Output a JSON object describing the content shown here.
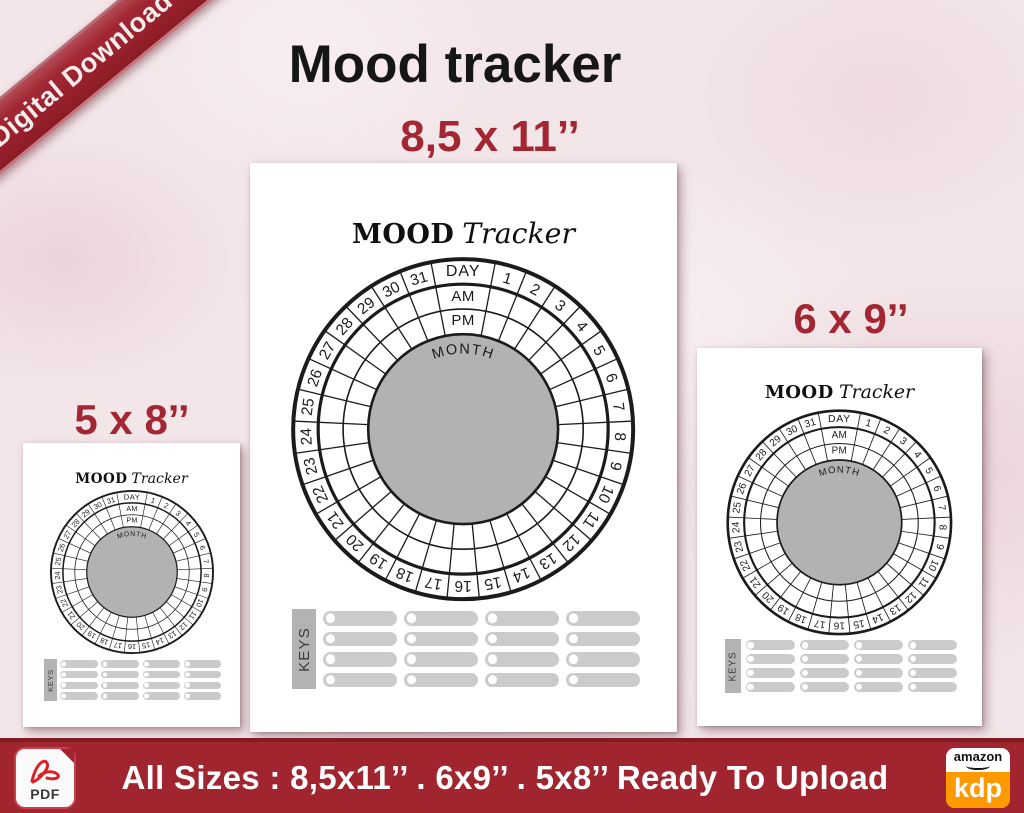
{
  "ribbon": {
    "label": "Digital Download"
  },
  "title": "Mood tracker",
  "tracker": {
    "heading_primary": "MOOD",
    "heading_secondary": "Tracker",
    "day_label": "DAY",
    "am_label": "AM",
    "pm_label": "PM",
    "month_label": "MONTH",
    "day_count": 31,
    "keys_label": "KEYS",
    "keys_rows": 4,
    "keys_cols": 4
  },
  "pages": [
    {
      "size_label": "8,5 x 11’’"
    },
    {
      "size_label": "6 x 9’’"
    },
    {
      "size_label": "5 x 8’’"
    }
  ],
  "footer": {
    "pdf_label": "PDF",
    "text": "All Sizes :  8,5x11’’ . 6x9’’ . 5x8’’  Ready To Upload",
    "amazon_label": "amazon",
    "kdp_label": "kdp"
  },
  "colors": {
    "accent_red": "#a32733",
    "footer_red": "#a0252f",
    "kdp_orange": "#ff9900",
    "center_gray": "#b2b2b2",
    "key_bar_gray": "#cbcbcb",
    "keys_box_gray": "#b3b3b3"
  }
}
